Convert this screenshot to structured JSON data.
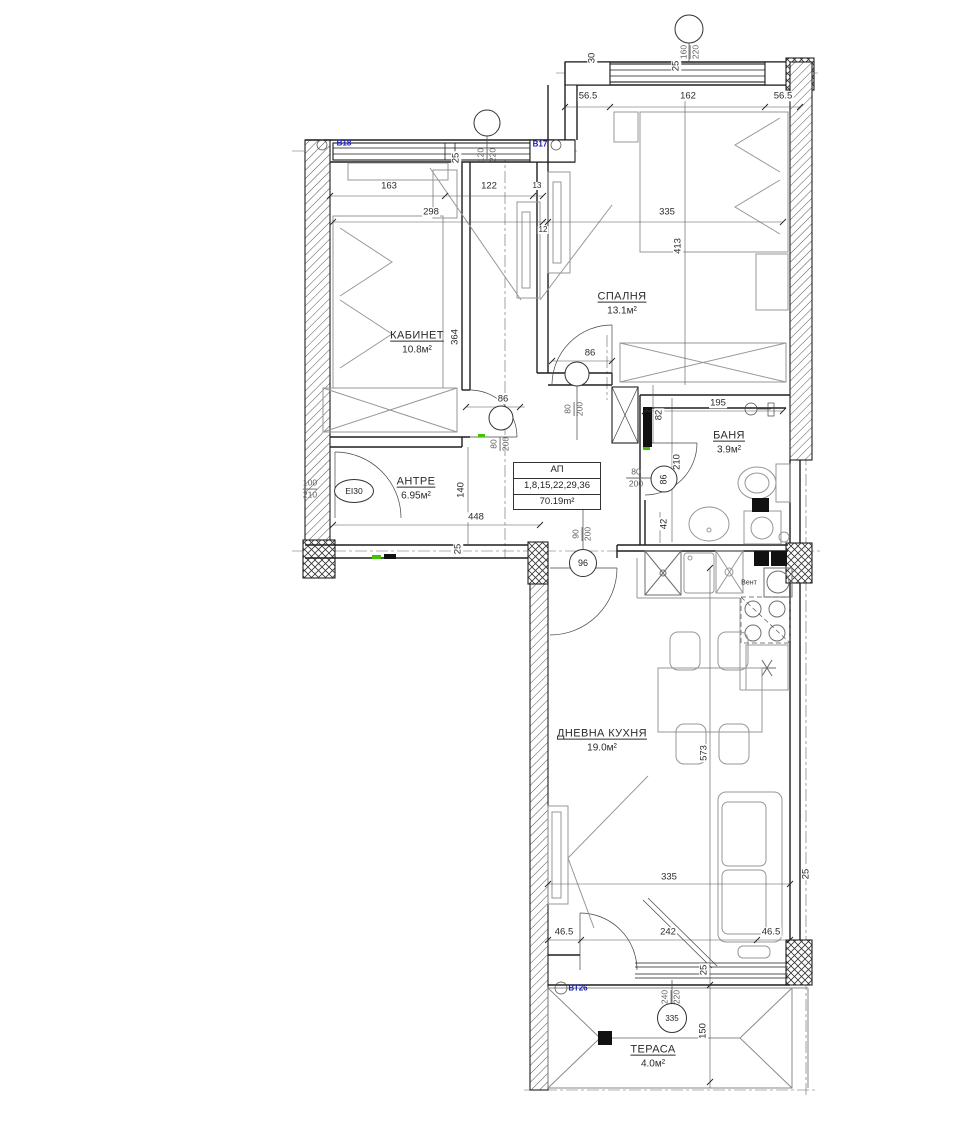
{
  "rooms": [
    {
      "name": "КАБИНЕТ",
      "area": "10.8м²"
    },
    {
      "name": "СПАЛНЯ",
      "area": "13.1м²"
    },
    {
      "name": "АНТРЕ",
      "area": "6.95м²"
    },
    {
      "name": "БАНЯ",
      "area": "3.9м²"
    },
    {
      "name": "ДНЕВНА КУХНЯ",
      "area": "19.0м²"
    },
    {
      "name": "ТЕРАСА",
      "area": "4.0м²"
    }
  ],
  "apartment_box": {
    "title": "АП",
    "units": "1,8,15,22,29,36",
    "area": "70.19m²"
  },
  "opening_labels": {
    "v18": "В18",
    "v17": "В17",
    "vt26": "ВТ26"
  },
  "entry_door": {
    "width": "100",
    "height": "210",
    "fire_rating": "EI30"
  },
  "door_sizes": {
    "interior_w": "80",
    "interior_h": "200",
    "living_w": "90",
    "living_h": "200",
    "terrace_w": "240",
    "terrace_h": "220"
  },
  "window_sizes": {
    "bedroom_w": "160",
    "bedroom_h": "220",
    "office_w": "120",
    "office_h": "220"
  },
  "door_circles": {
    "bath": "86",
    "living": "96",
    "terrace": "335"
  },
  "kitchen": {
    "vent_label": "Вент"
  },
  "icons": {
    "fridge_star": "✳"
  },
  "dims": {
    "d56_5": "56.5",
    "d162": "162",
    "d163": "163",
    "d122": "122",
    "d13": "13",
    "d12": "12",
    "d298": "298",
    "d335": "335",
    "d413": "413",
    "d364": "364",
    "d30": "30",
    "d25": "25",
    "d86": "86",
    "d140": "140",
    "d448": "448",
    "d195": "195",
    "d82": "82",
    "d210": "210",
    "d42": "42",
    "d573": "573",
    "d46_5": "46.5",
    "d242": "242",
    "d150": "150"
  },
  "colors": {
    "wall": "#1e1e1e",
    "furniture": "#979797",
    "label_blue": "#1a1ab8",
    "mark_green": "#41c300"
  }
}
